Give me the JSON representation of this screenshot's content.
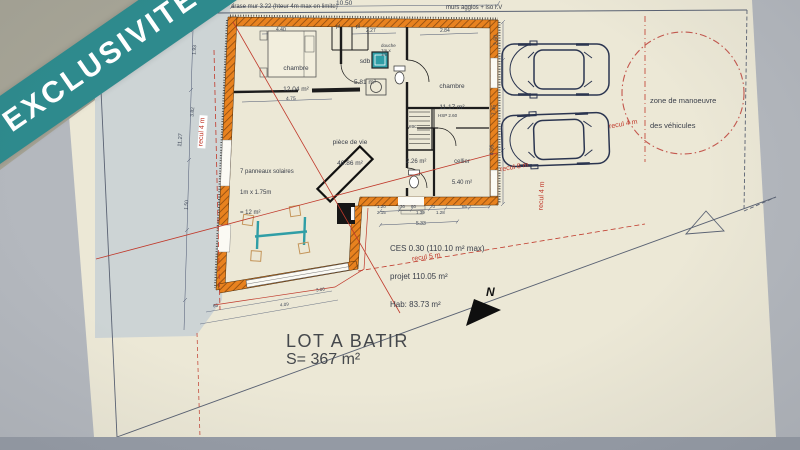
{
  "banner": {
    "label": "EXCLUSIVITÉ"
  },
  "plan": {
    "notes": {
      "top_left": "arase mur 3.22 (hteur 4m max en limite)",
      "top_right": "murs agglos + iso I.V"
    },
    "rooms": {
      "chambre1": {
        "name": "chambre",
        "area": "12.04 m²"
      },
      "sdb": {
        "name": "sdb",
        "area": "5.81 m²",
        "douche": "douche 1m x 1m"
      },
      "chambre2": {
        "name": "chambre",
        "area": "11.17 m²"
      },
      "piece_de_vie": {
        "name": "pièce de vie",
        "area": "46.86 m²"
      },
      "cellier": {
        "name": "cellier",
        "area": "5.40 m²"
      },
      "wc": {
        "area": "2.26 m²"
      },
      "esc": {
        "name": "esc"
      },
      "hsp": {
        "label": "HSP 2.60"
      },
      "placard1": "pl",
      "placard2": "pl"
    },
    "solar_note": {
      "line1": "7 panneaux solaires",
      "line2": "1m x 1.75m",
      "line3": "= 12 m²"
    },
    "project": {
      "line1": "CES 0.30 (110.10 m² max)",
      "line2": "projet 110.05 m²",
      "line3": "Hab: 83.73 m²"
    },
    "lot": {
      "title": "LOT A BATIR",
      "area": "S= 367 m²"
    },
    "zone_manoeuvre": {
      "line1": "zone de manoeuvre",
      "line2": "des véhicules"
    },
    "reculs": {
      "left": "recul 4 m",
      "right_diag": "recul 4 m",
      "right_8": "recul 8 m",
      "mid": "recul 4 m",
      "south": "recul 5 m"
    },
    "north_label": "N",
    "dims": {
      "top": "10.50",
      "right_260": "2.60",
      "right_745": "7.45",
      "right_456": "4.56",
      "left_total": "11.27",
      "left_193": "1.93",
      "left_382": "3.82",
      "left_150": "1.50",
      "w440": "4.40",
      "w475": "4.75",
      "w284": "2.84",
      "w227": "2.27",
      "b120": "1.20",
      "b215": "2.15",
      "b30": "30",
      "b80": "80",
      "b139": "1.39",
      "b70": "70",
      "b128": "1.28",
      "b85": "85",
      "b533": "5.33",
      "b65": "65",
      "b409": "4.09",
      "b306": "3.06"
    }
  },
  "colors": {
    "banner_teal": "#2e8a8d",
    "wall_orange": "#e8821f",
    "recul_red": "#c0392b",
    "paper": "#ece8d6",
    "parcel_gray": "#cdd4d5",
    "car_navy": "#2b3550",
    "table_teal": "#2f9ea6"
  }
}
